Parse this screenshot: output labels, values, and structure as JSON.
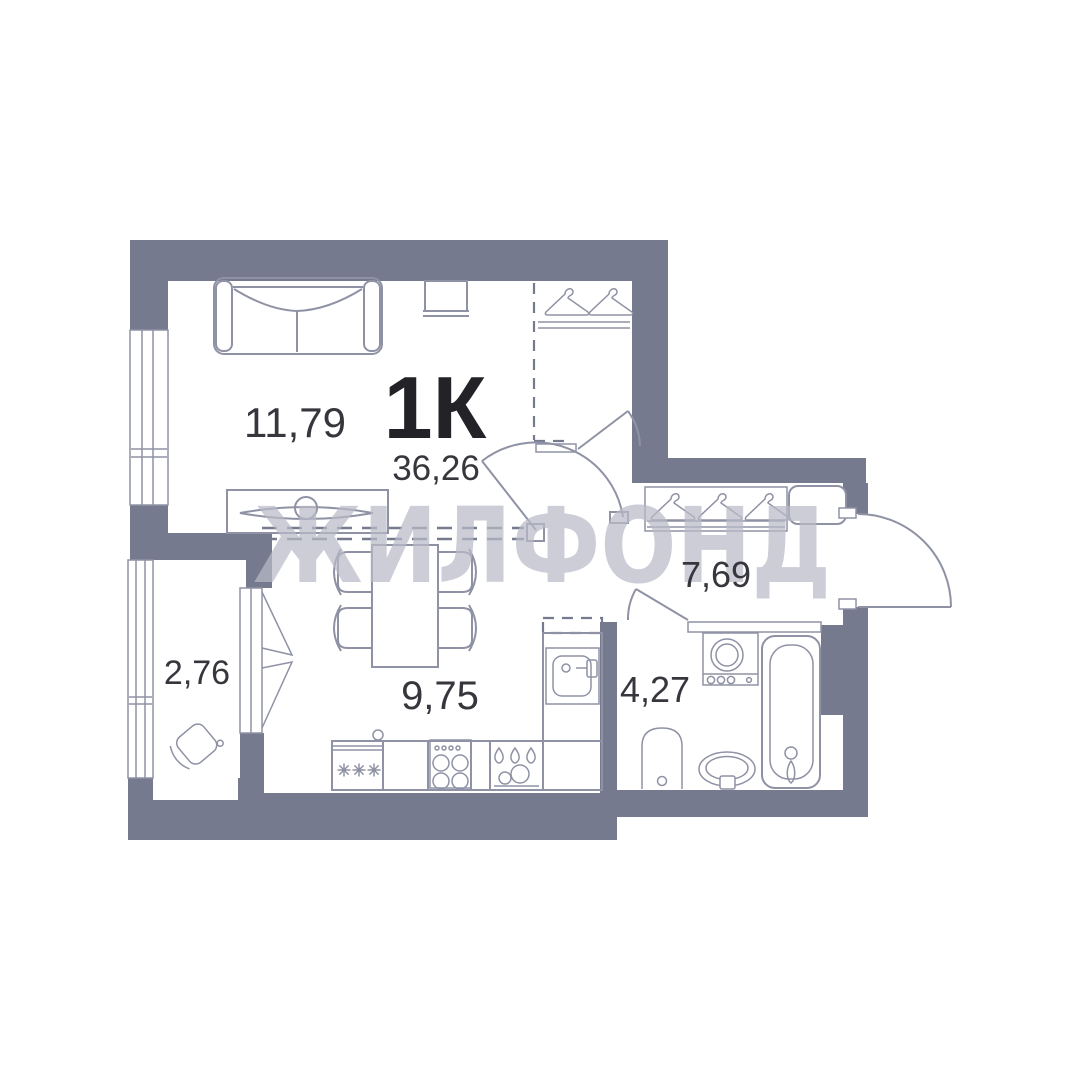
{
  "plan": {
    "apartment_type": "1К",
    "total_area": "36,26",
    "watermark": "ЖИЛФОНД",
    "rooms": [
      {
        "id": "living-room",
        "area": "11,79"
      },
      {
        "id": "kitchen",
        "area": "9,75"
      },
      {
        "id": "hallway",
        "area": "7,69"
      },
      {
        "id": "bathroom",
        "area": "4,27"
      },
      {
        "id": "balcony",
        "area": "2,76"
      }
    ],
    "colors": {
      "wall": "#757a8e",
      "fixture_line": "#8f92a4",
      "label_text": "#36363c",
      "type_text": "#232327",
      "watermark": "#b8bac6",
      "background": "#ffffff"
    }
  }
}
